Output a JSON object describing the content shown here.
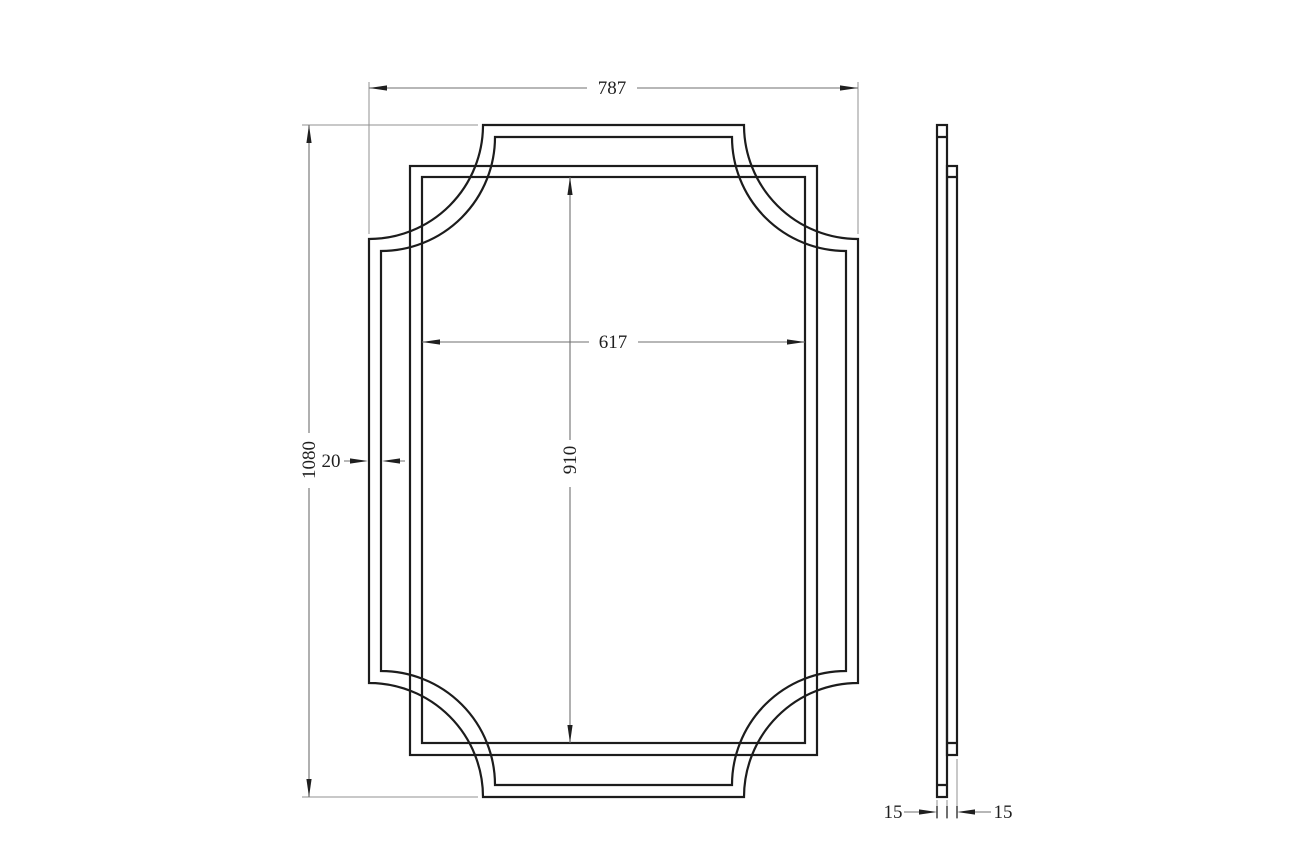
{
  "drawing_type": "technical-dimension-drawing",
  "views": {
    "front_view": "mirror frame with concave clipped corners",
    "side_view": "two-layer edge profile"
  },
  "dims": {
    "overall_width": "787",
    "overall_height": "1080",
    "inner_width": "617",
    "inner_height": "910",
    "frame_band": "20",
    "thickness_left": "15",
    "thickness_right": "15"
  },
  "colors": {
    "background": "#ffffff",
    "object_line": "#1c1c1c",
    "dim_line": "#6f6f6f",
    "ext_line": "#919191",
    "text_color": "#1f1f1f"
  }
}
